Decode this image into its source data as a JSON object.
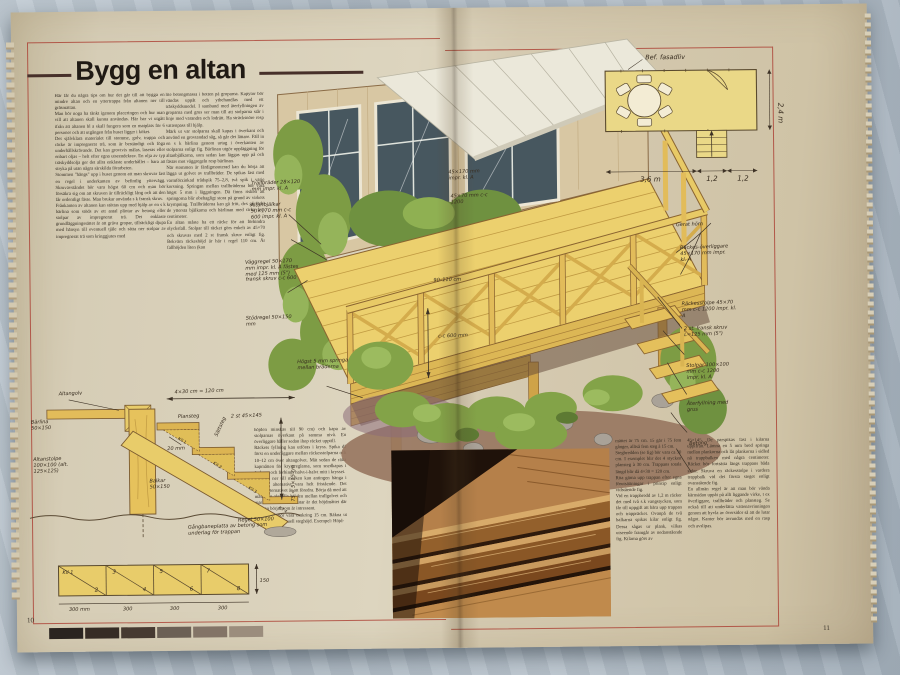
{
  "page": {
    "title": "Bygg en altan",
    "left_page_number": "10",
    "right_page_number": "11"
  },
  "columns": {
    "col1": "Här får du några tips om hur det går till att bygga en mindre altan och en yttertrappa från altanen ner till gräsmattan.\n  Man bör noga ha tänkt igenom placeringen och hur man vill att altanen skall kunna användas. Här har vi utgått ifrån att altanen bl a skall fungera som en matplats för 6 personer och att utgången från huset ligger i köket.\n  Det självklara materialet till stomme, golv, trappa och räcke är impregnerat trä, som är beständigt och föga underhållskrävande. Det kan grovtvis målas, laseras eller enbart oljas – helt efter egna utseendekrav. En olja av typ träskyddsolja ger det allra enklaste underhållet – bara att stryka på utan några särskilda förarbeten.\n  Stommen \"hängs\" upp i huset genom att man skruvar fast en regel i underkanten av befintlig yttervägg. Skruvavståndet bör vara högst 60 cm och man bör försäkra sig om att skruven är tillräckligt lång och att den får ordentligt fäste. Man brukar använda s k fransk skruv.\n  Frånkanten av altanen kan stöttas upp med hjälp av en s k bärlina som stöds av ett antal plintar av betong eller stolpar av impregnerat trä. Det enklaste grundläggningssättet är att gräva gropar, tillräckligt djupa med hänsyn till eventuell tjäle och sätta ner stolpar av impregnerat trä som kringgjutes med",
    "col2": "lite betongmassa i botten på groparna. Kapytor bör vändas uppåt och ytbehandlas med ett träskyddsmedel. I samband med återfyllningen av groparna med grus ser man till att stolparna står i linje med varandra och lodrätt. Ha sträcksnöre resp vattenpass till hjälp.\n  Märk ut var stolparna skall kapas i överkant och använd en grovtandad såg, så går det lättare. Fäll in en s k bärlina genom urtag i överkanten av stolparna enligt fig. Bärlinan utgör uppläggning för altanbjälkarna, som sedan kan läggas upp på och fästas mot väggregeln resp bärlinan.\n  När stommen är färdigmonterad kan du börja att lägga ut golvet av trallbräder. De spikas fast med varmförzinkad trådspik 75–2,8, två spik i varje korsning. Springan mellan trallbräderna bör vara högst 5 mm i läggningen. Då finns risken att springorna blir obehagligt stora på grund av virkets krympning. Trallbräderna kan gå fritt, dvs gå förbi de yttersta bjälkarna och bärlinan med cirka fem centimeter.\n  En altan måste ha ett räcke för att förhindra olycksfall. Stolpar till räcket görs enkelt av 45×70 och skruvas med 2 st fransk skruv enligt fig. Bekväm räckeshöjd är här i regel 110 cm. Är fallhöjden liten (kan",
    "col3": "höjden minskas till 90 cm) och kapa av stolparnas överkant på samma nivå. En överliggare håller sedan ihop räcket upptill.\n  Räckets fyllning kan utföras i kryss. Spika då först en underliggare mellan räckesstolparna och 10–12 cm över altangolvet. Mät sedan de rätta kapmåtten för kryssreglarna, som snedkapas i ändarna och förbinds halvt-i-halvt mitt i krysset.\n  Trappan ner till marken kan antingen hänga i altanen, alternativt vara helt fristående. Det första alternativet är att föredra. Börja då med att mäta den aktuella höjden mellan trallgolvet och marken. Om marken lutar är det höjdmåttet där trappan börjar som är intressant.\n  Steghöjden bör vara omkring 15 cm. Räkna ut och bestäm eventuell steghöjd. Exempel: Höjd-",
    "col4": "måttet är 75 cm. 15 går i 75 fem gånger, alltså fem steg à 15 cm.\n  Stegbredden (se fig) bör vara ca 30 cm. I exemplet blir det 4 stycken plansteg à 30 cm. Trappans totala längd blir då 4×30 = 120 cm.\n  Rita gärna upp trappan efter egna förutsättningar i princip enligt vidstående fig.\n  Vid en trappbredd av 1,2 m räcker det med två s.k vangstycken, som får till uppgift att bära upp trappan och trappräcket. Ovanpå de två balkarna spikas kilar enligt fig. Dessa sågas ur plank, vilkas utseende framgår av nedanstående fig. Kilarna görs av",
    "col5": "45×145. De parspikas fast i kilarna uppifrån. Lämna en 5 mm bred springa mellan plankorna och låt plankorna i sidled nå trappbalken med några centimeter. Räcket bör fortsätta längs trappans båda sidor. Skruva en räckesstolpe i vardera trappbalk vid det första steget enligt ovanstående fig.\n  En allmän regel är att man bör vända kärnsidan uppåt på allt liggande virke, t ex överliggare, trallbräder och plansteg. Se också till att underlätta vattenavrinningen genom att hyvla av översidor så att de lutar något. Kanter bör avrundas med en rasp och avslipas."
  },
  "plan": {
    "label_facade": "Bef. fasadliv",
    "dim_width": "3,6 m",
    "dim_step1": "1,2",
    "dim_step2": "1,2",
    "dim_depth": "2,4 m"
  },
  "ann": {
    "trallbrader": "Trallbräder 28×120 mm impr. kl. A",
    "altanbjalkar": "Altanbjälkar 50×170 mm c-c 600 impr. kl. A",
    "vaggregel": "Väggregel 50×170 mm impr. kl. A fästes med 125 mm (5\") fransk skruv c-c 600",
    "stodregel": "Stödregel 50×150 mm",
    "springa": "Högst 5 mm springa mellan bräderna",
    "raildim1": "45×170 mm impr. kl. A",
    "raildim2": "45×70 mm c-c 1200",
    "rackeshojd": "90–110 cm",
    "cc600": "c-c 600 mm",
    "gerat_horn": "Gerat hörn",
    "rackesoverliggare": "Räckes-överliggare 45×170 mm impr. kl. A",
    "rackesstolpe": "Räckesstolpe 45×70 mm c-c 1200 impr. kl. A",
    "fransk_skruv": "2 st. fransk skruv L=125 mm (5\")",
    "stolpar": "Stolpar 100×100 mm c-c 1200 impr. kl. A",
    "aterfyllning": "Återfyllning med grus",
    "betong": "Betong"
  },
  "stairs": {
    "altangolv": "Altangolv",
    "dim_top": "4×30 cm = 120 cm",
    "barlina": "Bärlina 50×150",
    "plansteg": "Plansteg",
    "sattsteg": "Sättsteg",
    "two_st": "2 st 45×145",
    "overhang": "20 mm",
    "kil1": "Kil 1",
    "kil2": "Kil 2",
    "kil3": "Kil 3",
    "kil4": "Kil 4",
    "dim_right": "75 = 5×15 cm",
    "altanstolpe": "Altanstolpe 100×100 (alt. 125×125)",
    "balkar": "Balkar 50×150",
    "regel": "Regel 50×100",
    "caption": "Gångbaneplatta av betong som underlag för trappan"
  },
  "plank": {
    "numbers": [
      "Kil 1",
      "2",
      "3",
      "4",
      "5",
      "6",
      "7",
      "8"
    ],
    "height": "150",
    "dims": [
      "300 mm",
      "300",
      "300",
      "300"
    ]
  },
  "strip": {
    "colors": [
      "#2a2420",
      "#362c25",
      "#463a31",
      "#6b6055",
      "#837467",
      "#9b8d7d"
    ]
  },
  "colors": {
    "paper": "#d8cfb8",
    "red_rule": "#a8342a",
    "cloth": "#b3bec8",
    "deck_wood": "#ecd06e",
    "beam_wood": "#d9b452",
    "foliage": "#83a348",
    "window": "#47575f",
    "photo_wood": "#b5804a",
    "photo_shadow": "#241409",
    "ink": "#362b1e"
  }
}
